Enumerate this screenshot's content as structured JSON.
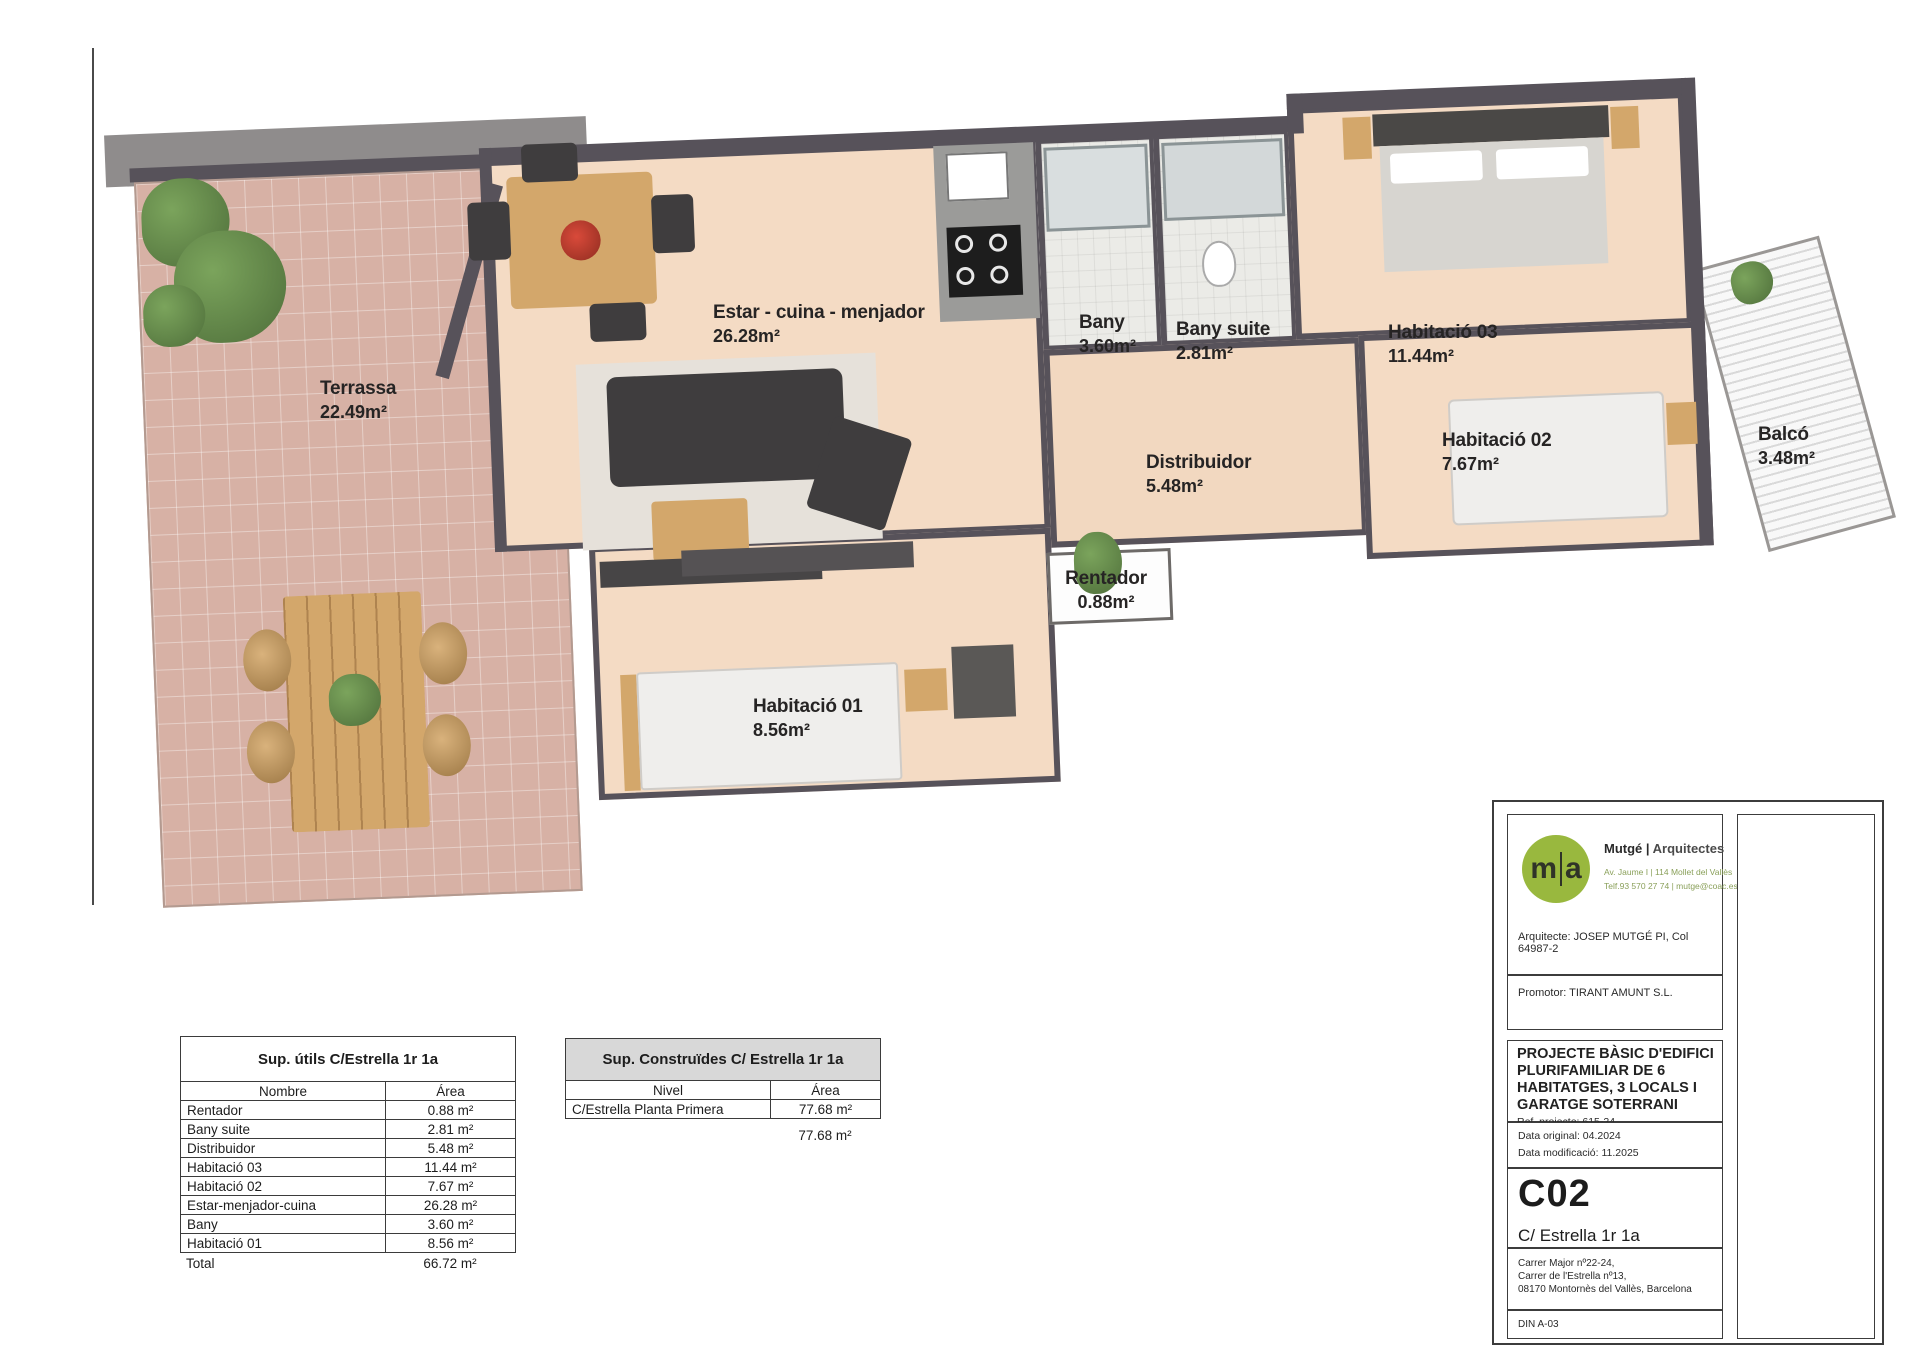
{
  "plan": {
    "rooms": [
      {
        "name": "Terrassa",
        "area": "22.49m²"
      },
      {
        "name": "Estar - cuina - menjador",
        "area": "26.28m²"
      },
      {
        "name": "Bany",
        "area": "3.60m²"
      },
      {
        "name": "Bany suite",
        "area": "2.81m²"
      },
      {
        "name": "Habitació 03",
        "area": "11.44m²"
      },
      {
        "name": "Habitació 02",
        "area": "7.67m²"
      },
      {
        "name": "Distribuidor",
        "area": "5.48m²"
      },
      {
        "name": "Rentador",
        "area": "0.88m²"
      },
      {
        "name": "Habitació 01",
        "area": "8.56m²"
      },
      {
        "name": "Balcó",
        "area": "3.48m²"
      }
    ]
  },
  "tables": {
    "utils": {
      "title": "Sup. útils C/Estrella 1r 1a",
      "col_name": "Nombre",
      "col_area": "Área",
      "rows": [
        [
          "Rentador",
          "0.88 m²"
        ],
        [
          "Bany suite",
          "2.81 m²"
        ],
        [
          "Distribuidor",
          "5.48 m²"
        ],
        [
          "Habitació 03",
          "11.44 m²"
        ],
        [
          "Habitació 02",
          "7.67 m²"
        ],
        [
          "Estar-menjador-cuina",
          "26.28 m²"
        ],
        [
          "Bany",
          "3.60 m²"
        ],
        [
          "Habitació 01",
          "8.56 m²"
        ]
      ],
      "total_label": "Total",
      "total_value": "66.72 m²"
    },
    "construides": {
      "title": "Sup. Construïdes C/ Estrella 1r 1a",
      "col_level": "Nivel",
      "col_area": "Área",
      "row_level": "C/Estrella Planta Primera",
      "row_area": "77.68 m²",
      "total_value": "77.68 m²"
    }
  },
  "titleblock": {
    "logo_left": "m",
    "logo_right": "a",
    "firm_name": "Mutgé |",
    "firm_suffix": "Arquitectes",
    "firm_address": "Av. Jaume I | 114 Mollet del Vallès",
    "firm_contact": "Telf.93 570 27 74 | mutge@coac.es",
    "architect_line": "Arquitecte: JOSEP MUTGÉ PI, Col 64987-2",
    "promotor_line": "Promotor: TIRANT AMUNT S.L.",
    "project_lines": [
      "PROJECTE BÀSIC D'EDIFICI",
      "PLURIFAMILIAR DE 6",
      "HABITATGES, 3 LOCALS I",
      "GARATGE SOTERRANI"
    ],
    "ref_line": "Ref. projecte: 615-24",
    "date_original": "Data original: 04.2024",
    "date_modified": "Data modificació: 11.2025",
    "sheet_code": "C02",
    "sheet_name": "C/ Estrella 1r 1a",
    "site_address_lines": [
      "Carrer Major nº22-24,",
      "Carrer de l'Estrella nº13,",
      "08170 Montornès del Vallès, Barcelona"
    ],
    "paper_format": "DIN A-03"
  },
  "colors": {
    "logo_green": "#99b83e",
    "terrace_tile": "#d7b1a5",
    "floor_peach": "#f4dbc4",
    "wall_gray": "#57525a",
    "table_header_gray": "#d8d8d8"
  }
}
